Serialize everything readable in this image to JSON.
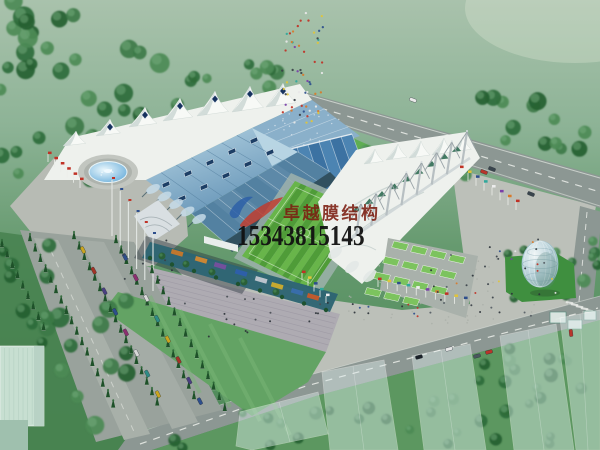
{
  "watermark": {
    "company_name": "卓越膜结构",
    "phone_number": "15343815143",
    "company_color": "#7c1d10",
    "phone_color": "#111111",
    "logo_blue": "#2b5ea8",
    "logo_red": "#c23a2b"
  },
  "scene": {
    "palette": {
      "lawn_top": "#a9c2ac",
      "lawn_mid": "#7aa684",
      "lawn_deep": "#4f8a5a",
      "tree_greens": [
        "#2e6b3a",
        "#3c7a47",
        "#4c8a55",
        "#255f31"
      ],
      "cypress_green": "#1e5129",
      "road_gray": "#8c9793",
      "plaza_gray": "#bcc0b9",
      "apron_gray": "#b7bbb4",
      "steps_gray": "#aeabb2",
      "roof_blue_light": "#b2d2e2",
      "roof_blue": "#6493b6",
      "bowl_blue": "#5d89a8",
      "membrane_white": "#eef1ed",
      "pitch_green": "#68b54a",
      "pitch_green_alt": "#4f9c38",
      "terrace_green": "#7cc35e",
      "water_blue": "#5aa5d6",
      "sphere_glass": "#cfe0e8",
      "flag_colors": [
        "#c03226",
        "#e0c43a",
        "#2d4e8c",
        "#2fa89c",
        "#ededed",
        "#7a3fa8",
        "#d87a2a"
      ],
      "car_colors": [
        "#c9a51f",
        "#a33326",
        "#4a3f80",
        "#2d4e8c",
        "#8c2f6f",
        "#d8d8d8",
        "#2f8c86"
      ]
    }
  }
}
